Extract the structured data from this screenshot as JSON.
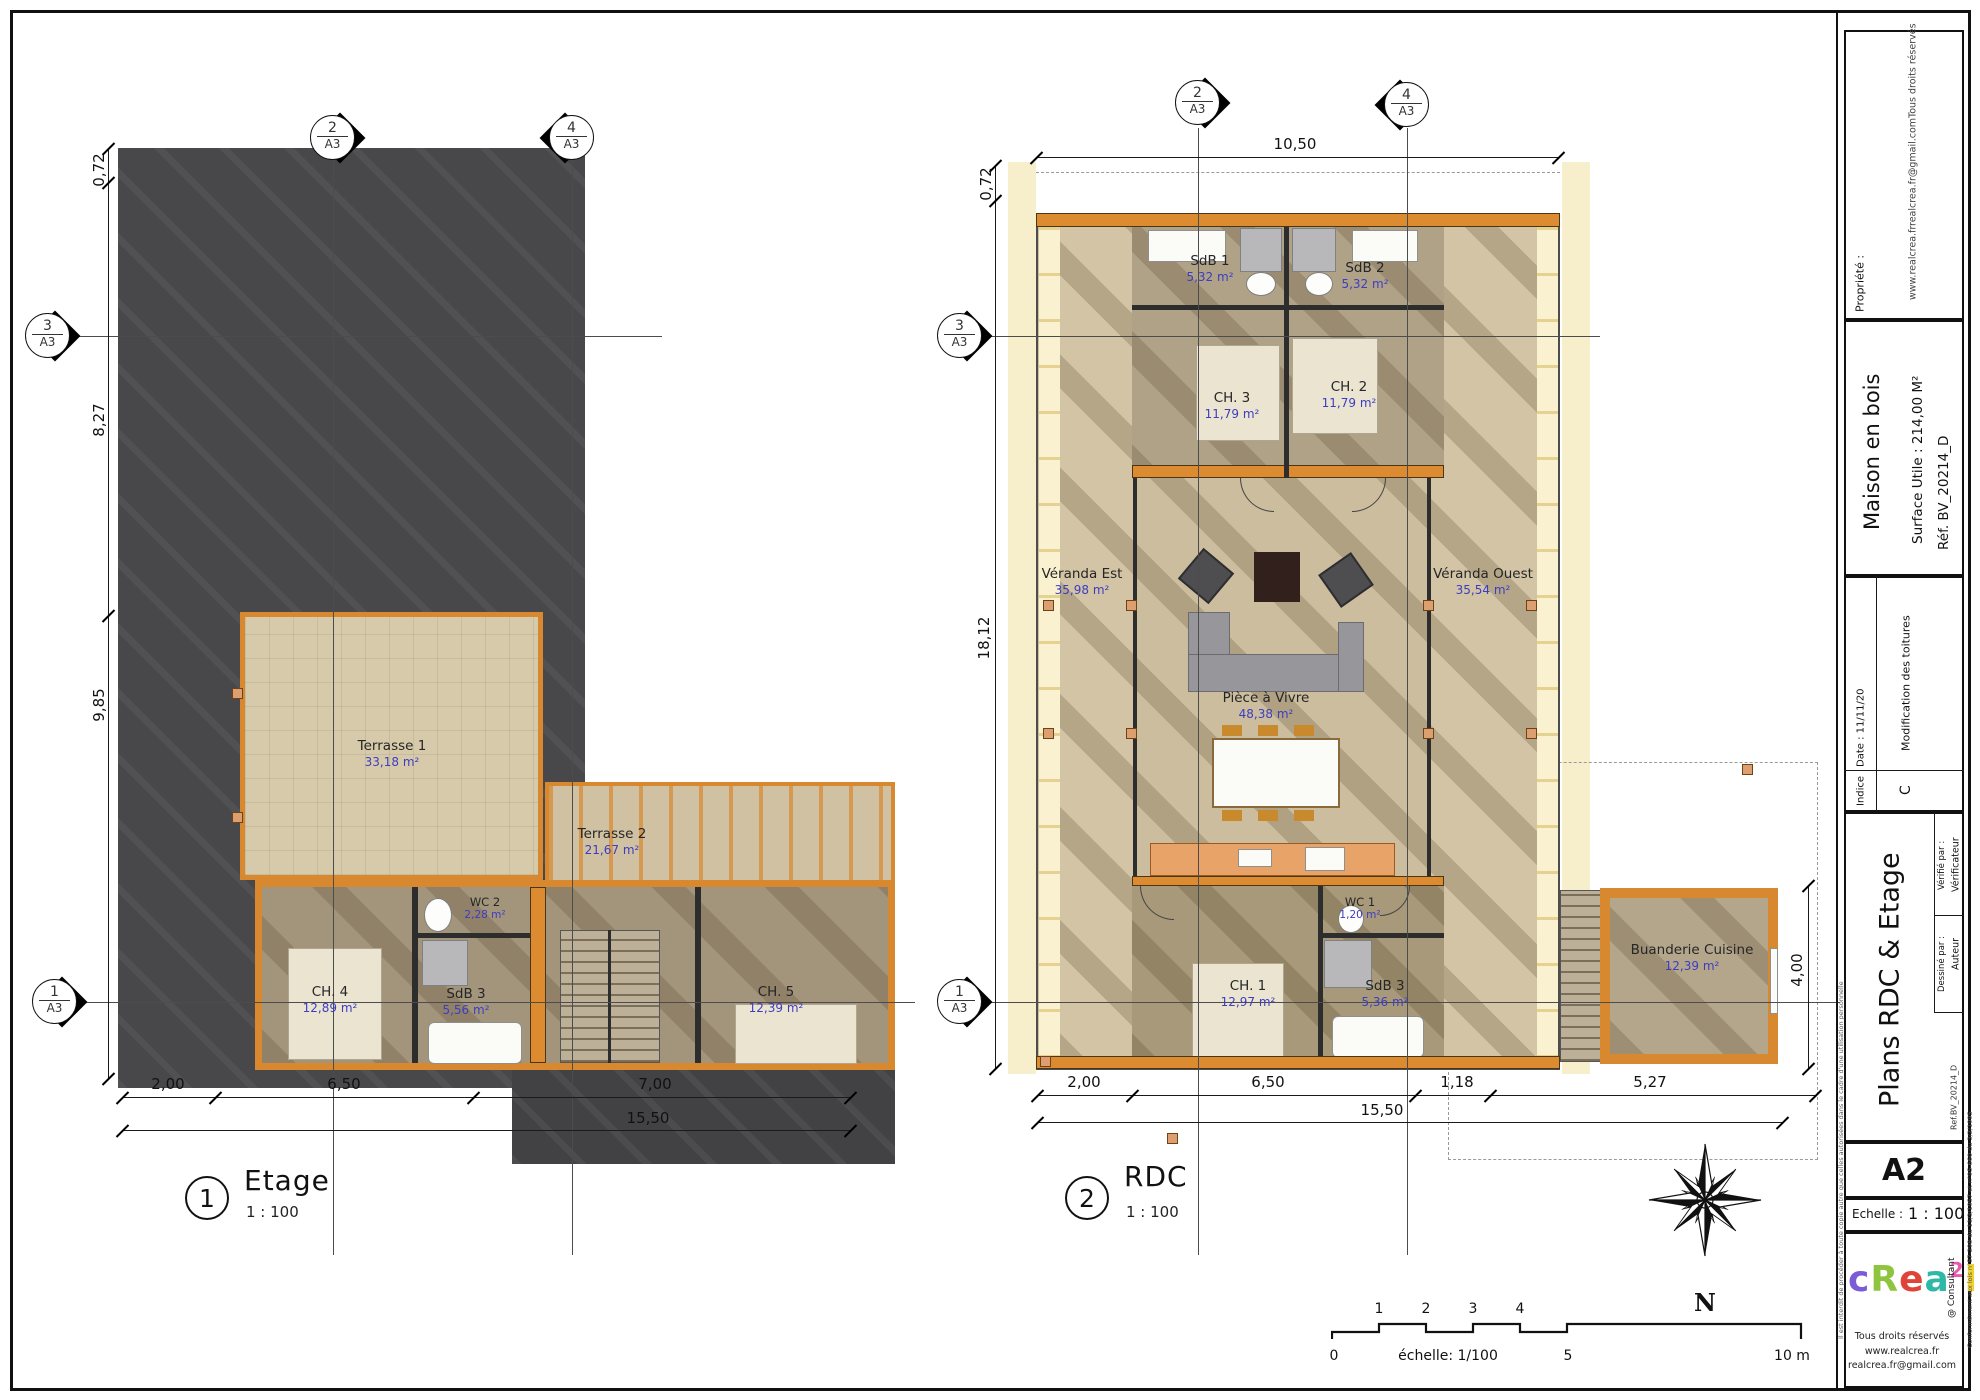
{
  "plans": [
    {
      "number": "1",
      "title": "Etage",
      "scale": "1 : 100",
      "rooms": [
        {
          "name": "Terrasse 1",
          "area": "33,18 m²"
        },
        {
          "name": "Terrasse 2",
          "area": "21,67 m²"
        },
        {
          "name": "WC 2",
          "area": "2,28 m²"
        },
        {
          "name": "CH. 4",
          "area": "12,89 m²"
        },
        {
          "name": "SdB 3",
          "area": "5,56 m²"
        },
        {
          "name": "CH. 5",
          "area": "12,39 m²"
        }
      ],
      "dims": {
        "left": [
          "0,72",
          "8,27",
          "9,85"
        ],
        "bottom": [
          "2,00",
          "6,50",
          "7,00"
        ],
        "total": "15,50"
      }
    },
    {
      "number": "2",
      "title": "RDC",
      "scale": "1 : 100",
      "rooms": [
        {
          "name": "SdB 1",
          "area": "5,32 m²"
        },
        {
          "name": "SdB 2",
          "area": "5,32 m²"
        },
        {
          "name": "CH. 3",
          "area": "11,79 m²"
        },
        {
          "name": "CH. 2",
          "area": "11,79 m²"
        },
        {
          "name": "Véranda Est",
          "area": "35,98 m²"
        },
        {
          "name": "Véranda Ouest",
          "area": "35,54 m²"
        },
        {
          "name": "Pièce à Vivre",
          "area": "48,38 m²"
        },
        {
          "name": "WC 1",
          "area": "1,20 m²"
        },
        {
          "name": "CH. 1",
          "area": "12,97 m²"
        },
        {
          "name": "SdB 3",
          "area": "5,36 m²"
        },
        {
          "name": "Buanderie Cuisine",
          "area": "12,39 m²"
        }
      ],
      "dims": {
        "top": "10,50",
        "left": [
          "0,72",
          "18,12"
        ],
        "bottom": [
          "2,00",
          "6,50",
          "1,18",
          "5,27"
        ],
        "total": "15,50",
        "right": "4,00"
      }
    }
  ],
  "section_markers": {
    "ref": "A3",
    "n1": "1",
    "n2": "2",
    "n3": "3",
    "n4": "4"
  },
  "compass": {
    "north_label": "N"
  },
  "scale_bar": {
    "above": [
      "1",
      "2",
      "3",
      "4"
    ],
    "zero": "0",
    "five": "5",
    "end": "10 m",
    "caption": "échelle: 1/100"
  },
  "title_block": {
    "propriete_label": "Propriété :",
    "credits": [
      "www.realcrea.fr",
      "realcrea.fr@gmail.com",
      "Tous droits réservés"
    ],
    "project_title": "Maison en bois",
    "surface": "Surface Utile : 214,00 M²",
    "reference": "Réf. BV_20214_D",
    "date": "Date :   11/11/20",
    "revision_note": "Modification des toitures",
    "indice_label": "Indice",
    "indice_value": "C",
    "sheet_title": "Plans RDC & Etage",
    "drawn_by_label": "Dessiné par :",
    "drawn_by": "Auteur",
    "checked_by_label": "Vérifié par :",
    "checked_by": "Vérificateur",
    "ref_small": "Ref.BV_20214_D",
    "format": "A2",
    "echelle_label": "Echelle :",
    "echelle_value": "1 : 100",
    "logo_letters": [
      {
        "ch": "c",
        "color": "#7b5bd6"
      },
      {
        "ch": "R",
        "color": "#8fc43f"
      },
      {
        "ch": "e",
        "color": "#e04438"
      },
      {
        "ch": "a",
        "color": "#2fb8a8"
      },
      {
        "ch": "2",
        "color": "#e957b2",
        "sup": true
      },
      {
        "ch": "l",
        "color": "#f0d22f"
      }
    ],
    "consultant": "@ Consultant",
    "footer": [
      "Tous droits réservés",
      "www.realcrea.fr",
      "realcrea.fr@gmail.com"
    ],
    "disclaimer_left": "Il est interdit de procéder à toute copie autre que celles autorisées dans le cadre d'une utilisation personnelle",
    "disclaimer_right": "Conformément aux lois n°57-298 du 11/3/1957 et n°95-660 du 3/2/1995"
  }
}
